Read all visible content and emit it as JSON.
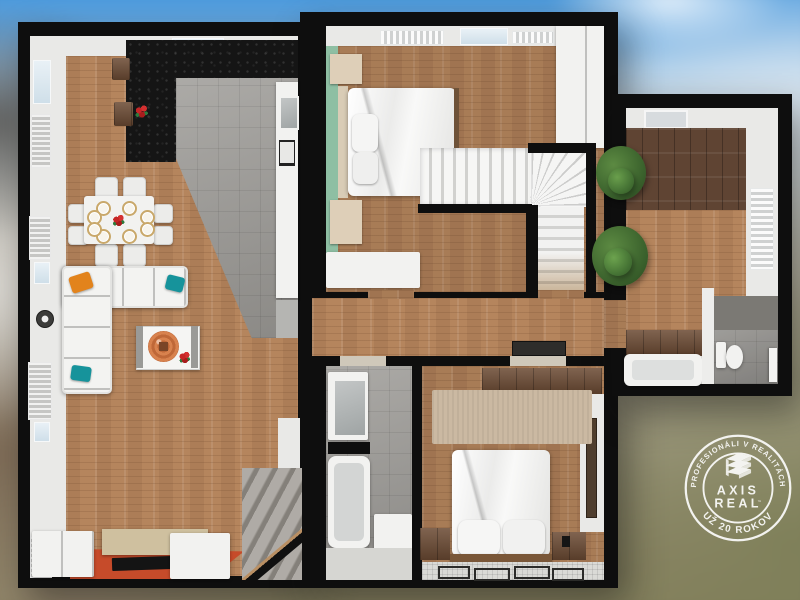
{
  "scene": {
    "description": "3D top-down dollhouse render of a two-level apartment floor plan with a side annex, shown over a blurred exterior photo",
    "rooms": [
      "kitchen",
      "dining-area",
      "living-room",
      "tv-area",
      "staircase-down",
      "bedroom-upper",
      "winder-staircase",
      "hallway",
      "bathroom",
      "bedroom-lower",
      "annex-hall",
      "annex-bathroom"
    ]
  },
  "watermark": {
    "shape": "circular-stamp",
    "arc_top": "PROFESIONÁLI V REALITÁCH",
    "arc_bottom": "UŽ 20 ROKOV",
    "brand_top": "AXIS",
    "brand_bottom": "REAL",
    "trademark": "™",
    "icon": "stacked-building-icon",
    "color": "#ffffff"
  },
  "palette": {
    "sky_blue": "#3f94dc",
    "wall_black": "#0e0e0e",
    "wall_white": "#e9e9e7",
    "wood_light": "#b5855d",
    "wood_dark": "#5f4433",
    "tile_gray": "#9e9c98",
    "granite_black": "#151515",
    "sofa_white": "#f2f2f0",
    "pillow_orange": "#e2831c",
    "pillow_teal": "#16939b",
    "wall_green": "#8ebfa3",
    "rug_orange": "#c64b2a",
    "rug_beige": "#cbb9a2",
    "foliage_green": "#46702f",
    "stair_concrete": "#99948d",
    "stamp_white": "#ffffff"
  }
}
